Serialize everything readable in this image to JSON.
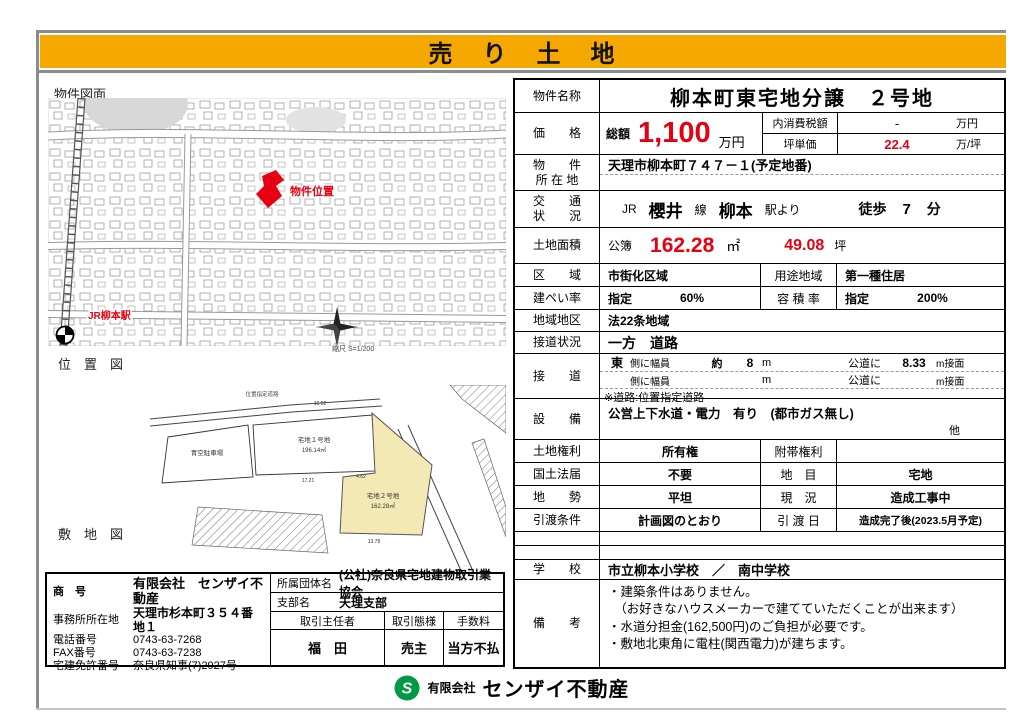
{
  "colors": {
    "banner_gold": "#F5A800",
    "accent_red": "#E60012",
    "lot_yellow": "#F2E9B5",
    "logo_green": "#009944"
  },
  "banner": {
    "title": "売　り　土　地"
  },
  "maps": {
    "drawing_title": "物件図面",
    "location_title": "位　置　図",
    "site_title": "敷　地　図",
    "marker_label": "物件位置",
    "station_label": "JR柳本駅",
    "scale_label": "縮尺  S=1/200",
    "road_label": "位置指定道路",
    "parking_label": "青空駐車場",
    "lot1_name": "宅地１号地",
    "lot1_area": "196.14㎡",
    "lot2_name": "宅地２号地",
    "lot2_area": "162.28㎡",
    "dim_top": "16.02",
    "dim_lot1": "17.21",
    "dim_mid": "4.62",
    "dim_bottom": "13.78"
  },
  "details": {
    "name_label": "物件名称",
    "name_value": "柳本町東宅地分譲　２号地",
    "price_label": "価　　格",
    "price_prefix": "総額",
    "price_value": "1,100",
    "price_unit": "万円",
    "tax_label": "内消費税額",
    "tax_value": "-",
    "tax_unit": "万円",
    "unit_price_label": "坪単価",
    "unit_price_value": "22.4",
    "unit_price_unit": "万/坪",
    "loc_label_1": "物　　件",
    "loc_label_2": "所 在 地",
    "loc_value": "天理市柳本町７４７－１(予定地番)",
    "transport_label_1": "交　　通",
    "transport_label_2": "状　　況",
    "transport_jr": "JR",
    "transport_line": "櫻井",
    "transport_line_suffix": "線",
    "transport_station": "柳本",
    "transport_from": "駅より",
    "transport_walk": "徒歩",
    "transport_min": "7",
    "transport_min_unit": "分",
    "area_label": "土地面積",
    "area_prefix": "公簿",
    "area_m2": "162.28",
    "area_m2_unit": "㎡",
    "area_tsubo": "49.08",
    "area_tsubo_unit": "坪",
    "zone_label": "区　　域",
    "zone_value": "市街化区域",
    "use_label": "用途地域",
    "use_value": "第一種住居",
    "bcr_label": "建ぺい率",
    "bcr_prefix": "指定",
    "bcr_value": "60%",
    "far_label": "容 積 率",
    "far_prefix": "指定",
    "far_value": "200%",
    "district_label": "地域地区",
    "district_value": "法22条地域",
    "frontage_label": "接道状況",
    "frontage_value": "一方　道路",
    "road_label": "接　　道",
    "road1_dir": "東",
    "road1_t": "側に幅員",
    "road1_approx": "約",
    "road1_w": "8",
    "road1_unit": "m",
    "road1_pub": "公道に",
    "road1_len": "8.33",
    "road1_len_unit": "m接面",
    "road2_t": "側に幅員",
    "road2_unit": "m",
    "road2_pub": "公道に",
    "road2_len_unit": "m接面",
    "road_note": "※道路:位置指定道路",
    "util_label": "設　　備",
    "util_value": "公営上下水道・電力　有り　(都市ガス無し)",
    "util_other": "他",
    "right_label": "土地権利",
    "right_value": "所有権",
    "sub_right_label": "附帯権利",
    "sub_right_value": "",
    "kokudo_label": "国土法届",
    "kokudo_value": "不要",
    "chimoku_label": "地　目",
    "chimoku_value": "宅地",
    "terrain_label": "地　　勢",
    "terrain_value": "平坦",
    "status_label": "現　況",
    "status_value": "造成工事中",
    "delivery_label": "引渡条件",
    "delivery_value": "計画図のとおり",
    "date_label": "引 渡 日",
    "date_value": "造成完了後(2023.5月予定)",
    "school_label": "学　　校",
    "school_value": "市立柳本小学校　／　南中学校",
    "remarks_label": "備　　考",
    "remarks_lines": [
      "・建築条件はありません。",
      "　（お好きなハウスメーカーで建てていただくことが出来ます）",
      "・水道分担金(162,500円)のご負担が必要です。",
      "・敷地北東角に電柱(関西電力)が建ちます。"
    ]
  },
  "company": {
    "name_label": "商　号",
    "name_value": "有限会社　センザイ不動産",
    "office_label": "事務所所在地",
    "office_value": "天理市杉本町３５４番地１",
    "tel_label": "電話番号",
    "tel_value": "0743-63-7268",
    "fax_label": "FAX番号",
    "fax_value": "0743-63-7238",
    "license_label": "宅建免許番号",
    "license_value": "奈良県知事(7)2927号",
    "assoc_label": "所属団体名",
    "assoc_value": "(公社)奈良県宅地建物取引業協会",
    "branch_label": "支部名",
    "branch_value": "天理支部",
    "agent_header": "取引主任者",
    "type_header": "取引態様",
    "fee_header": "手数料",
    "agent_value": "福　田",
    "type_value": "売主",
    "fee_value": "当方不払"
  },
  "footer": {
    "company_prefix": "有限会社",
    "company_name": "センザイ不動産"
  }
}
